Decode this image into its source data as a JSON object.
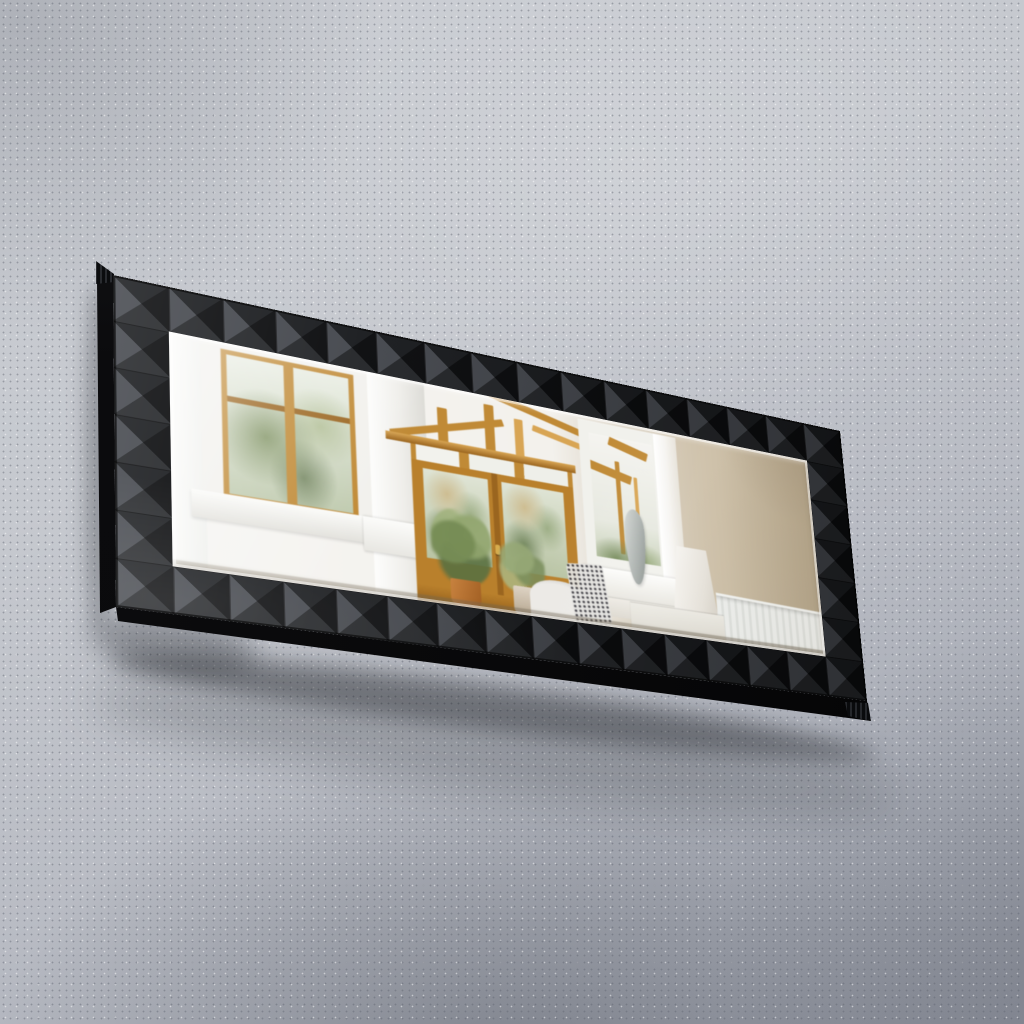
{
  "title": "Black geometric 3D-framed rectangular wall mirror hanging on a grey concrete wall, reflecting a sunlit conservatory interior",
  "image_type": "product-photograph",
  "scene": {
    "background_wall": {
      "material": "speckled grey concrete",
      "lighting": "soft diffuse daylight, brighter upper area, darker lower corners"
    },
    "mirror": {
      "shape": "landscape rectangle",
      "pose": "hung flat on wall, photographed from the left so the right side recedes",
      "frame": {
        "style": "3D pyramid relief tiles",
        "tile_columns": 16,
        "tile_rows": 7,
        "finish": "matte black with grey facet highlights",
        "edge_detail": "stacked serrated canvas-style edge at top-left and bottom-right corners",
        "visible_sides": [
          "left side face",
          "bottom side face"
        ]
      },
      "glass": {
        "bevel": "polished bevelled edge with bright white rim",
        "sheen": "diagonal light sheen from upper left"
      },
      "reflection": {
        "scene": "sunlit conservatory interior with golden oak glazing",
        "elements": [
          {
            "name": "white-framed window with oak sashes and garden greenery",
            "position": "left"
          },
          {
            "name": "white wall pillar with moulded base",
            "position": "left-center"
          },
          {
            "name": "glazed gable roof with oak rafters and posts",
            "position": "upper center"
          },
          {
            "name": "oak transom windows above doors",
            "position": "upper center"
          },
          {
            "name": "oak french doors with glass panes and brass handle",
            "position": "center"
          },
          {
            "name": "two potted green plants",
            "position": "lower center"
          },
          {
            "name": "white seat with black-and-white patterned cushion",
            "position": "lower center-right"
          },
          {
            "name": "white interior window opening onto conservatory beams",
            "position": "center-right"
          },
          {
            "name": "grey ceramic vase on white sill",
            "position": "center-right"
          },
          {
            "name": "plain beige wall",
            "position": "right"
          },
          {
            "name": "white lampshade on slim stem",
            "position": "lower right"
          },
          {
            "name": "white panel radiator with fins",
            "position": "bottom right"
          },
          {
            "name": "white baseboard moulding",
            "position": "bottom right"
          }
        ]
      },
      "shadow": "soft dark shadow cast on the wall below and to the left of the mirror"
    }
  },
  "colors": {
    "wallLight": "#ced1d7",
    "wallMid": "#bdc0c8",
    "wallDark": "#989ca7",
    "frameBlack": "#121316",
    "facetLeft": "#46494f",
    "facetBottom": "#26282b",
    "facetTop": "#1b1d20",
    "facetRight": "#0c0d0f",
    "frameSide": "#0a0a0c",
    "oak": "#c08a36",
    "oakLight": "#d8a554",
    "oakDark": "#9a651f",
    "whiteTrim": "#f2f1ed",
    "greenery": "#7d9055",
    "greeneryLight": "#aebf96",
    "thatch": "#cdba8c",
    "beigeWall": "#c3b49a",
    "beigeWallDark": "#a3937a",
    "brass": "#d8ad4e",
    "vaseGray": "#a8aeab",
    "radiatorWhite": "#edefed",
    "shadow": "#1c1e24"
  }
}
